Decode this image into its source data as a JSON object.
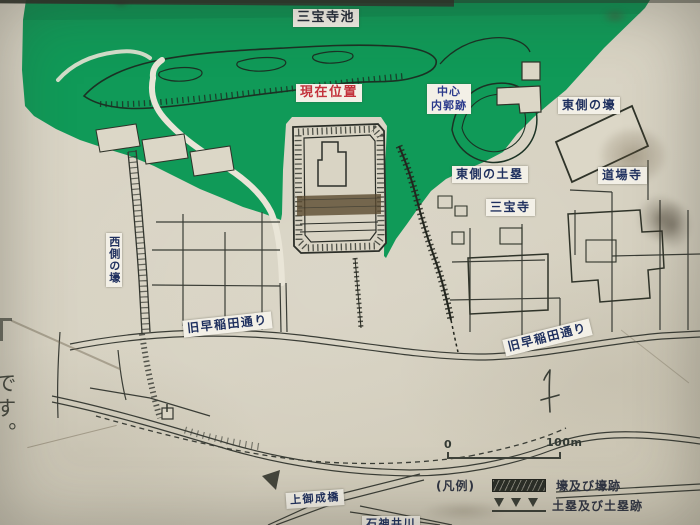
{
  "labels": {
    "pond": "三宝寺池",
    "current_location": "現在位置",
    "inner_ward_line1": "中心",
    "inner_ward_line2": "内郭跡",
    "east_moat": "東側の壕",
    "dojo_temple": "道場寺",
    "east_earthwork": "東側の土塁",
    "sanpoji_temple": "三宝寺",
    "west_moat": "西側の壕",
    "old_waseda_street_left": "旧早稲田通り",
    "old_waseda_street_right": "旧早稲田通り",
    "kamionari_bridge": "上御成橋",
    "shakujii_river": "石神井川",
    "side_text_fragment": "です。"
  },
  "legend": {
    "heading": "(凡例)",
    "moat_label": "壕及び壕跡",
    "earthwork_label": "土塁及び土塁跡"
  },
  "scale_bar": {
    "start": "0",
    "end": "100m"
  },
  "colors": {
    "park_green": "#109a58",
    "paper_beige": "#d7d2c2",
    "map_line_dark": "#33362f",
    "label_navy": "#1e2f5e",
    "current_location_red": "#c3323c",
    "inner_ward_blue": "#2b3a8c",
    "earthwork_brown": "#5a4a30"
  }
}
